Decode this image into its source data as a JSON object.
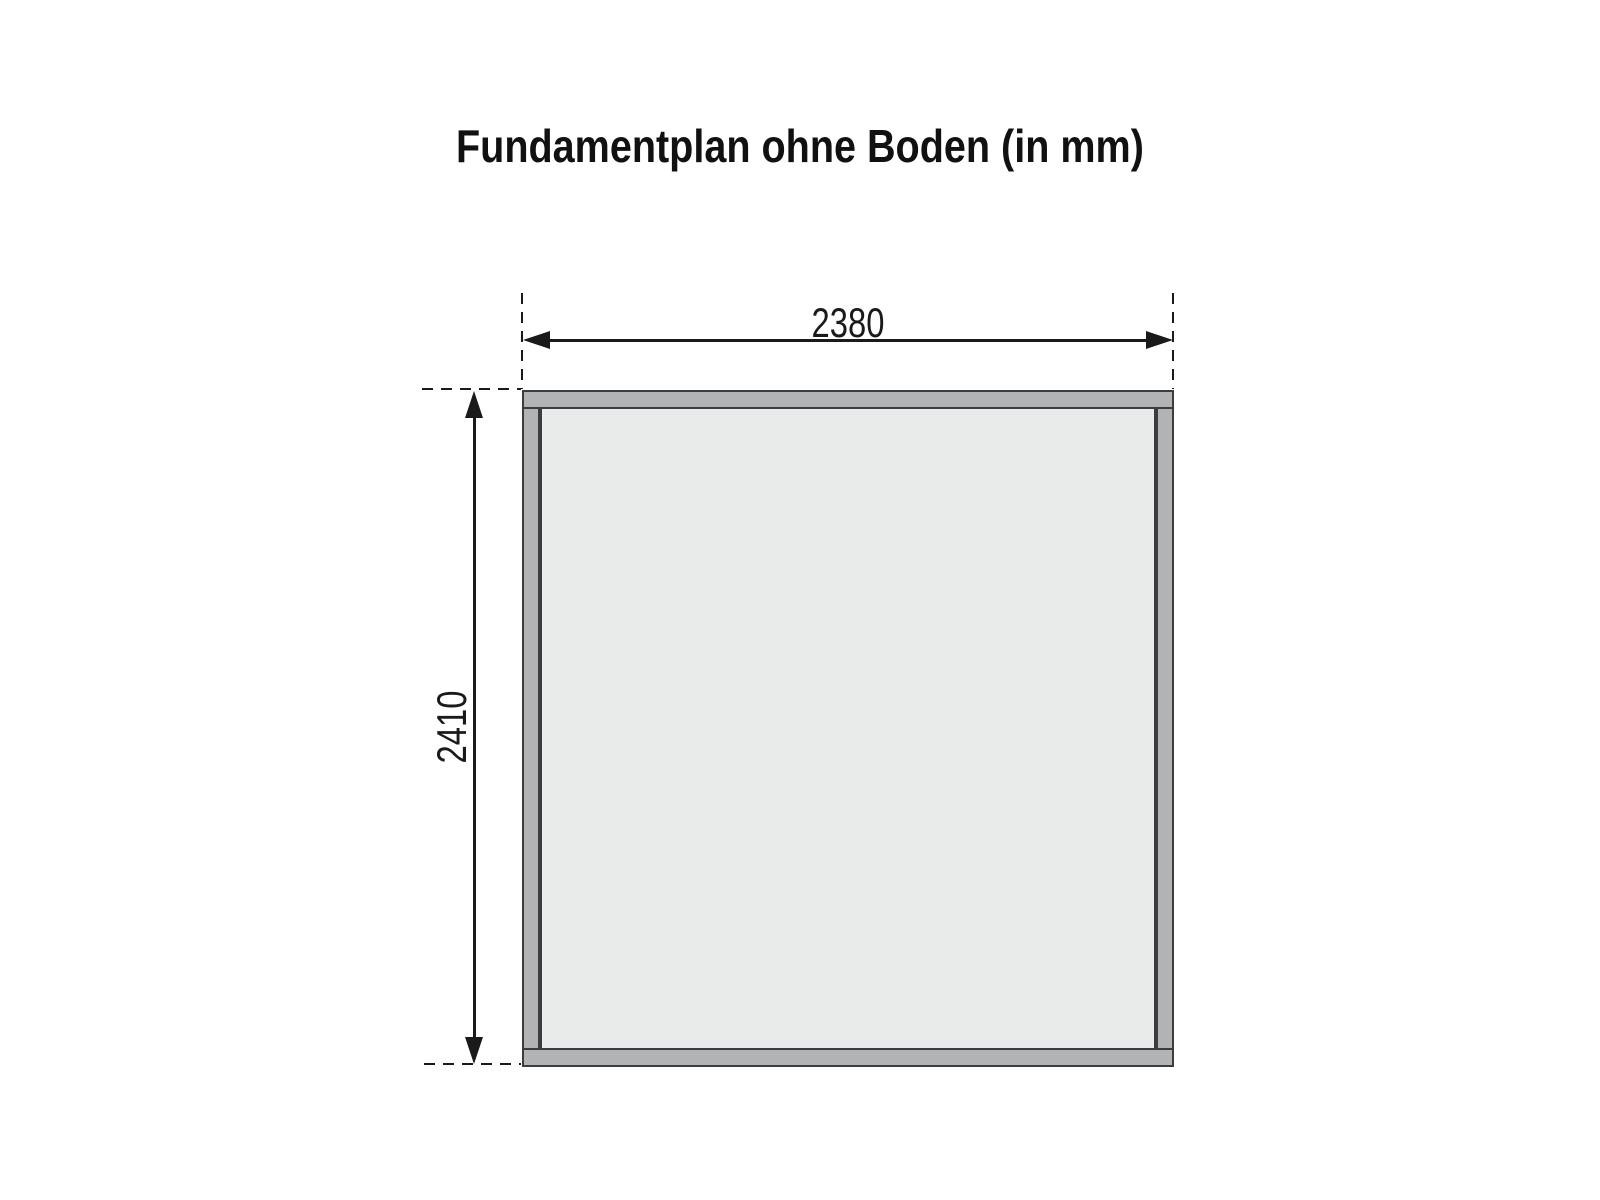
{
  "title": "Fundamentplan ohne Boden (in mm)",
  "dimensions": {
    "width_label": "2380",
    "height_label": "2410"
  },
  "colors": {
    "beam_fill": "#b1b3b5",
    "beam_outline": "#3a3d40",
    "inner_fill": "#e9ebeb",
    "line_color": "#1a1a1a",
    "background": "#ffffff"
  }
}
